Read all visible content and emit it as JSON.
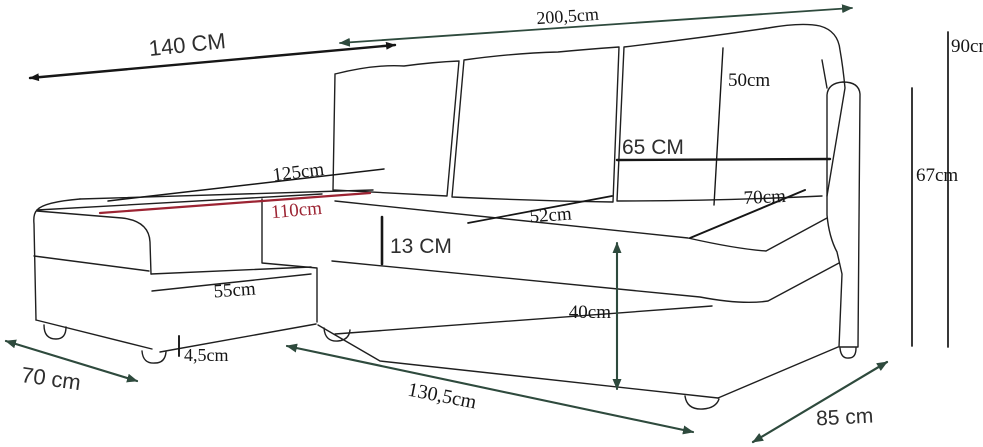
{
  "page": {
    "title": "Corner sofa dimensions diagram",
    "background": "#ffffff",
    "unit": "cm"
  },
  "style": {
    "outline_color": "#1f1f1f",
    "dimension_black": "#161616",
    "dimension_green": "#2e4a3d",
    "dimension_red": "#9c2433"
  },
  "labels": {
    "chaise_length": "140 CM",
    "total_width": "200,5cm",
    "total_height": "90cm",
    "back_cushion_height": "50cm",
    "backrest_cushion_width": "65 CM",
    "armrest_height": "67cm",
    "seat_depth_right": "70cm",
    "chaise_top_length": "125cm",
    "chaise_top_inner_length": "110cm",
    "seat_depth_mid": "52cm",
    "seat_front_band_height": "13 CM",
    "chaise_front_length": "55cm",
    "seat_height": "40cm",
    "foot_height": "4,5cm",
    "chaise_end_width": "70 cm",
    "body_front_length": "130,5cm",
    "side_depth": "85 cm"
  },
  "measurements": [
    {
      "id": "chaise-length",
      "label": "140 CM",
      "value": 140,
      "unit": "cm",
      "color": "#161616",
      "style": "double-arrow"
    },
    {
      "id": "total-width",
      "label": "200,5cm",
      "value": 200.5,
      "unit": "cm",
      "color": "#2e4a3d",
      "style": "double-arrow"
    },
    {
      "id": "total-height",
      "label": "90cm",
      "value": 90,
      "unit": "cm",
      "color": "#161616",
      "style": "line"
    },
    {
      "id": "back-cushion-height",
      "label": "50cm",
      "value": 50,
      "unit": "cm",
      "color": "#161616",
      "style": "line"
    },
    {
      "id": "backrest-cushion-width",
      "label": "65 CM",
      "value": 65,
      "unit": "cm",
      "color": "#161616",
      "style": "line"
    },
    {
      "id": "armrest-height",
      "label": "67cm",
      "value": 67,
      "unit": "cm",
      "color": "#161616",
      "style": "line"
    },
    {
      "id": "seat-depth-right",
      "label": "70cm",
      "value": 70,
      "unit": "cm",
      "color": "#161616",
      "style": "line"
    },
    {
      "id": "chaise-top-length",
      "label": "125cm",
      "value": 125,
      "unit": "cm",
      "color": "#161616",
      "style": "line"
    },
    {
      "id": "chaise-top-inner-length",
      "label": "110cm",
      "value": 110,
      "unit": "cm",
      "color": "#9c2433",
      "style": "line"
    },
    {
      "id": "seat-depth-mid",
      "label": "52cm",
      "value": 52,
      "unit": "cm",
      "color": "#161616",
      "style": "line"
    },
    {
      "id": "seat-front-band-height",
      "label": "13 CM",
      "value": 13,
      "unit": "cm",
      "color": "#161616",
      "style": "tick"
    },
    {
      "id": "chaise-front-length",
      "label": "55cm",
      "value": 55,
      "unit": "cm",
      "color": "#161616",
      "style": "line"
    },
    {
      "id": "seat-height",
      "label": "40cm",
      "value": 40,
      "unit": "cm",
      "color": "#2e4a3d",
      "style": "double-arrow"
    },
    {
      "id": "foot-height",
      "label": "4,5cm",
      "value": 4.5,
      "unit": "cm",
      "color": "#161616",
      "style": "tick"
    },
    {
      "id": "chaise-end-width",
      "label": "70 cm",
      "value": 70,
      "unit": "cm",
      "color": "#2e4a3d",
      "style": "double-arrow"
    },
    {
      "id": "body-front-length",
      "label": "130,5cm",
      "value": 130.5,
      "unit": "cm",
      "color": "#2e4a3d",
      "style": "double-arrow"
    },
    {
      "id": "side-depth",
      "label": "85 cm",
      "value": 85,
      "unit": "cm",
      "color": "#2e4a3d",
      "style": "double-arrow"
    }
  ]
}
